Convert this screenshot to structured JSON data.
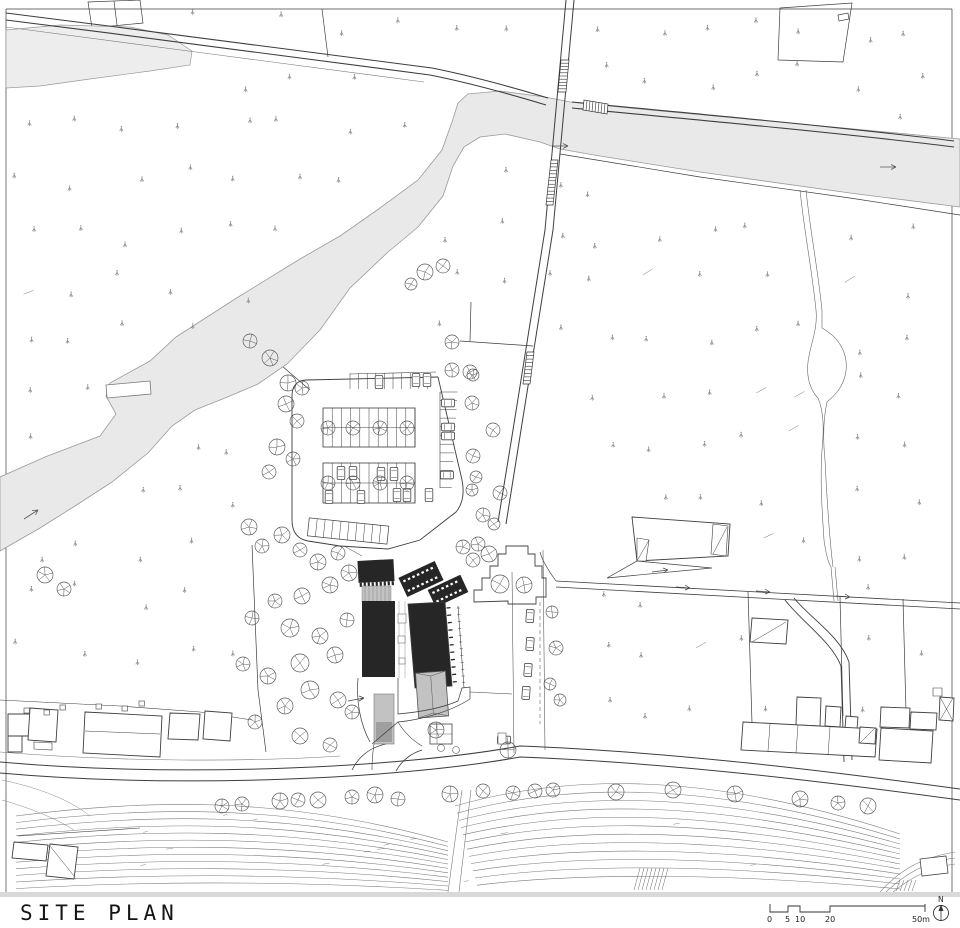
{
  "sheet": {
    "background": "#ffffff"
  },
  "title": {
    "label": "SITE PLAN"
  },
  "scale_bar": {
    "labels": [
      "0",
      "5",
      "10",
      "20",
      "50m"
    ]
  },
  "north_indicator": {
    "label": "N"
  },
  "colors": {
    "line": "#3d3d3d",
    "thin_line": "#777777",
    "water_fill": "#e9e9e9",
    "water_edge": "#9a9a9a",
    "pond_fill": "#ededed",
    "building_solid": "#262626",
    "building_gray": "#c2c2c2",
    "building_gray_dark": "#9e9e9e",
    "context_building_stroke": "#3f3f3f",
    "tree_stroke": "#555555",
    "vegetation_mark": "#8a8a8a",
    "contour": "#7a7a7a",
    "edge_strip": "#d9d9d9"
  }
}
